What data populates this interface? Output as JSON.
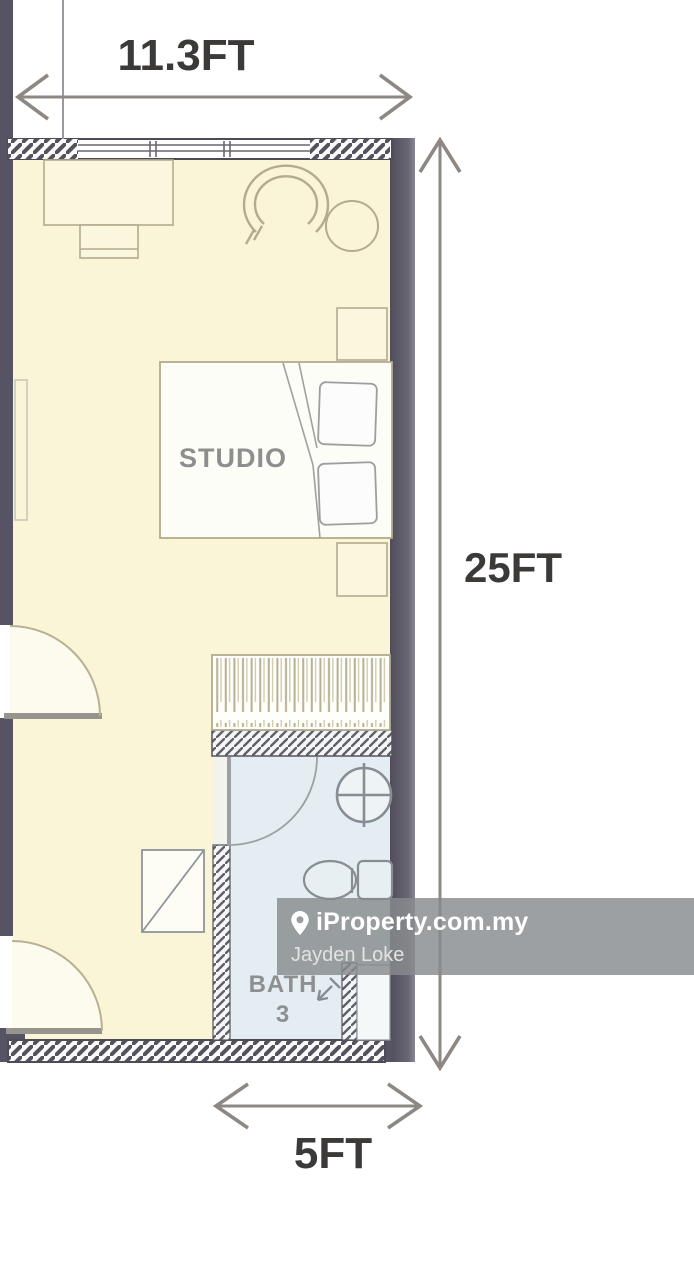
{
  "floorplan": {
    "labels": {
      "room": "STUDIO",
      "bath_line1": "BATH",
      "bath_line2": "3"
    },
    "dimensions": {
      "top_width": "11.3FT",
      "right_height": "25FT",
      "bottom_width": "5FT"
    },
    "colors": {
      "wall": "#57545f",
      "floor": "#faf5d6",
      "bath_floor": "#e4eef2",
      "furniture_outline": "#b3ab8e",
      "fixture_outline": "#878d93",
      "dimension_arrow": "#8d8883",
      "dimension_text": "#3b3a39",
      "room_label": "#8e8e8e"
    },
    "icons": [
      "bed",
      "pillow",
      "wardrobe",
      "desk",
      "chair",
      "swivel-chair",
      "side-table",
      "nightstand",
      "door-swing",
      "sink",
      "toilet",
      "shower"
    ]
  },
  "watermark": {
    "brand": "iProperty.com.my",
    "agent": "Jayden Loke",
    "pin_icon": "location-pin",
    "background": "rgba(136,139,141,0.82)"
  }
}
